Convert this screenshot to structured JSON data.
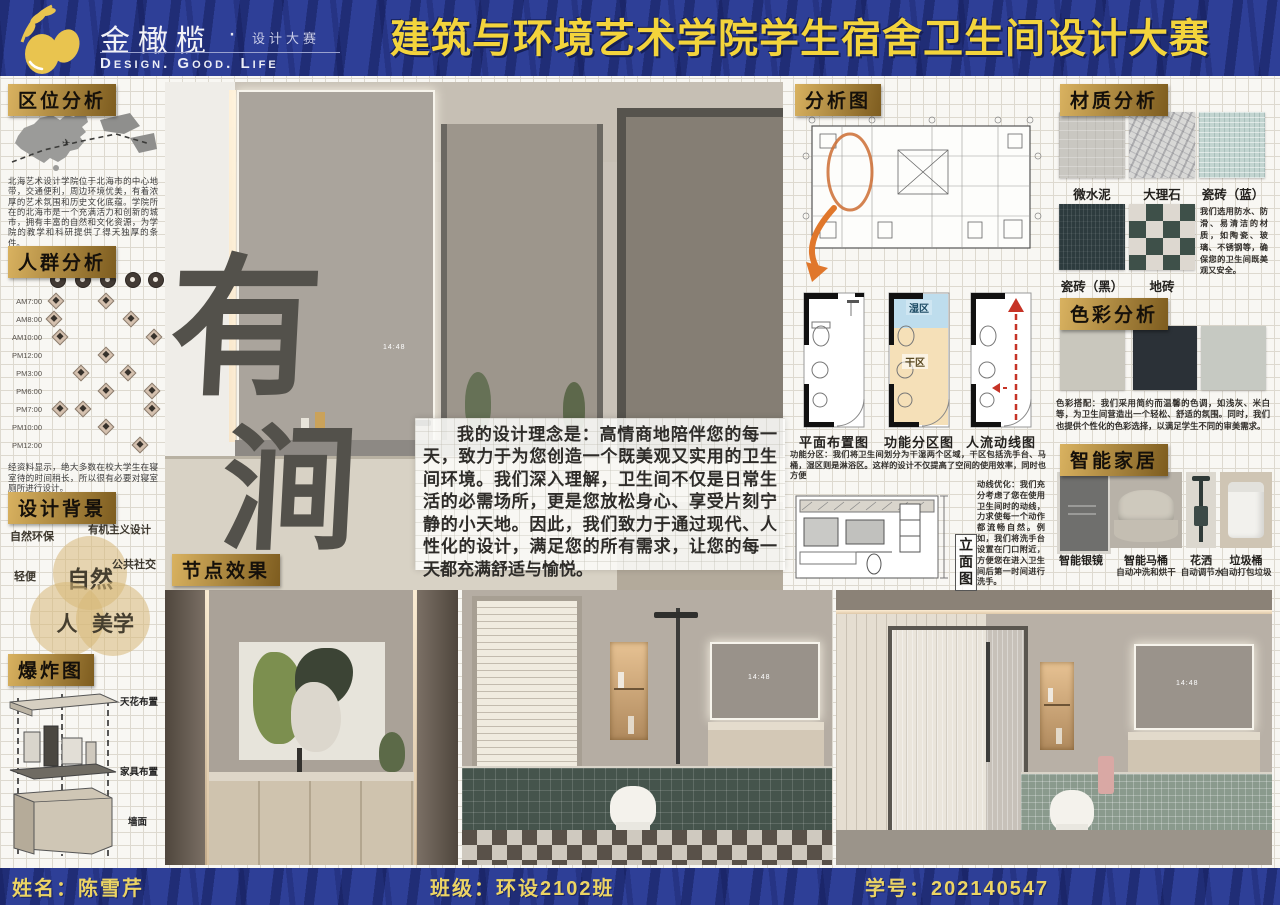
{
  "banner": {
    "logo_name": "金橄榄",
    "logo_sep": "·",
    "logo_sub": "设计大赛",
    "logo_en": "Design. Good. Life",
    "title": "建筑与环境艺术学院学生宿舍卫生间设计大赛"
  },
  "footer": {
    "name": "姓名：陈雪芹",
    "class": "班级：环设2102班",
    "student_id": "学号：202140547"
  },
  "theme": {
    "banner_blue": "#2e3f97",
    "title_yellow": "#f3d43c",
    "chip_gold": "#c59a4e",
    "wet_blue": "#aed4e8",
    "dry_orange": "#f2d6a0",
    "arrow_orange": "#e0772b",
    "flow_red": "#c63326"
  },
  "sections": {
    "location": {
      "title": "区位分析",
      "body": "北海艺术设计学院位于北海市的中心地带，交通便利，周边环境优美，有着浓厚的艺术氛围和历史文化底蕴。学院所在的北海市是一个充满活力和创新的城市，拥有丰富的自然和文化资源，为学院的教学和科研提供了得天独厚的条件。"
    },
    "population": {
      "title": "人群分析",
      "times": [
        "AM7:00",
        "AM8:00",
        "AM10:00",
        "PM12:00",
        "PM3:00",
        "PM6:00",
        "PM7:00",
        "PM10:00",
        "PM12:00"
      ],
      "body": "经资料显示，绝大多数在校大学生在寝室待的时间稍长，所以很有必要对寝室厕所进行设计。"
    },
    "background": {
      "title": "设计背景",
      "labels": [
        "自然环保",
        "有机主义设计",
        "轻便",
        "公共社交"
      ],
      "venn": [
        "自然",
        "人",
        "美学"
      ]
    },
    "exploded": {
      "title": "爆炸图",
      "labels": [
        "天花布置",
        "家具布置",
        "墙面"
      ]
    },
    "nodes": {
      "title": "节点效果"
    },
    "analysis": {
      "title": "分析图",
      "plans": [
        "平面布置图",
        "功能分区图",
        "人流动线图"
      ],
      "wet": "湿区",
      "dry": "干区",
      "zoning": "功能分区：我们将卫生间划分为干湿两个区域，干区包括洗手台、马桶，湿区则是淋浴区。这样的设计不仅提高了空间的使用效率，同时也方便",
      "elevation": "立面图",
      "circulation": "动线优化：我们充分考虑了您在使用卫生间时的动线，力求使每一个动作都流畅自然。例如，我们将洗手台设置在门口附近，方便您在进入卫生间后第一时间进行洗手。"
    },
    "materials": {
      "title": "材质分析",
      "items": [
        "微水泥",
        "大理石",
        "瓷砖（蓝）",
        "瓷砖（黑）",
        "地砖"
      ],
      "body": "我们选用防水、防滑、易清洁的材质，如陶瓷、玻璃、不锈钢等，确保您的卫生间既美观又安全。"
    },
    "colors": {
      "title": "色彩分析",
      "swatches": [
        "#c9c7bd",
        "#2b3137",
        "#c6c9c2"
      ],
      "body": "色彩搭配：我们采用简约而温馨的色调，如浅灰、米白等，为卫生间营造出一个轻松、舒适的氛围。同时，我们也提供个性化的色彩选择，以满足学生不同的审美需求。"
    },
    "smart": {
      "title": "智能家居",
      "items": [
        {
          "name": "智能银镜"
        },
        {
          "name": "智能马桶",
          "desc": "自动冲洗和烘干"
        },
        {
          "name": "花洒",
          "desc": "自动调节水"
        },
        {
          "name": "垃圾桶",
          "desc": "自动打包垃圾"
        }
      ]
    }
  },
  "main": {
    "calligraphy_1": "有",
    "calligraphy_2": "涧",
    "philosophy": "我的设计理念是：高情商地陪伴您的每一天，致力于为您创造一个既美观又实用的卫生间环境。我们深入理解，卫生间不仅是日常生活的必需场所，更是您放松身心、享受片刻宁静的小天地。因此，我们致力于通过现代、人性化的设计，满足您的所有需求，让您的每一天都充满舒适与愉悦。",
    "mirror_time": "14:48"
  }
}
